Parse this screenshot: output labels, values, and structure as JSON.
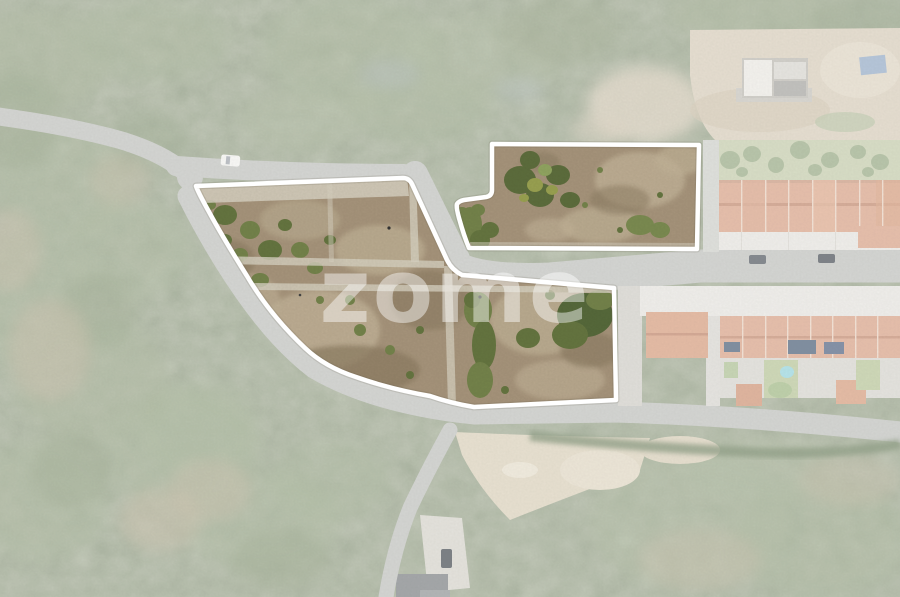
{
  "scene": {
    "description": "Aerial drone photograph of two land plots for sale, outlined in white; surrounding forest, roads and terraced houses are faded",
    "plot_count": 2,
    "regions": [
      "forest",
      "roads",
      "main-plot",
      "secondary-plot",
      "terraced-houses",
      "construction-site",
      "sand-clearing"
    ]
  },
  "watermark": {
    "text": "zome",
    "color": "#ffffff",
    "opacity": "0.45"
  },
  "colors": {
    "plot_boundary": "#ffffff",
    "boundary_shadow": "#6b6555",
    "plot_terrain": "#a5937a",
    "forest_faded": "#a6b097",
    "road": "#bdbfbb",
    "roof_terracotta": "#d99d80",
    "house_front": "#e7e5e0",
    "backyard_green": "#c3cba8",
    "pool_blue": "#8fd4de",
    "solar_panel": "#3f5570",
    "sand": "#dbd0b8",
    "white_car": "#f4f4f1",
    "dark_car": "#464d55",
    "fade_overlay": "#ffffff"
  }
}
